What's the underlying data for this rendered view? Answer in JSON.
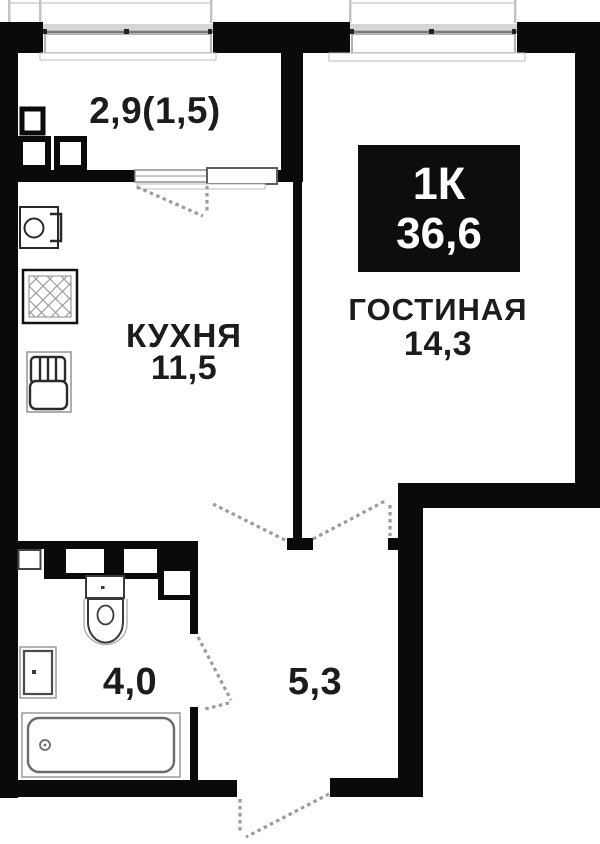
{
  "badge": {
    "rooms_label": "1К",
    "total_area": "36,6"
  },
  "rooms": {
    "balcony": {
      "label": "2,9(1,5)"
    },
    "kitchen": {
      "name": "КУХНЯ",
      "area": "11,5"
    },
    "living": {
      "name": "ГОСТИНАЯ",
      "area": "14,3"
    },
    "bathroom": {
      "area": "4,0"
    },
    "hallway": {
      "area": "5,3"
    }
  },
  "icons": {
    "kitchen": [
      "kitchen-sink-icon",
      "hob-icon",
      "stove-icon"
    ],
    "balcony": [
      "ac-unit-icon",
      "ac-unit-icon",
      "ac-unit-icon"
    ],
    "bathroom": [
      "toilet-icon",
      "washbasin-icon",
      "bathtub-icon",
      "duct-shaft-icon"
    ]
  },
  "colors": {
    "wall": "#0a0a0a",
    "bg": "#ffffff",
    "window": "#8f8f8f",
    "window_light": "#d6d6d6",
    "dashed": "#9b9b9b",
    "fixture": "#3a3a3a",
    "fixture_light": "#9a9a9a",
    "badge_bg": "#0d0d0d",
    "badge_text": "#ffffff",
    "text": "#1c1c1c"
  }
}
